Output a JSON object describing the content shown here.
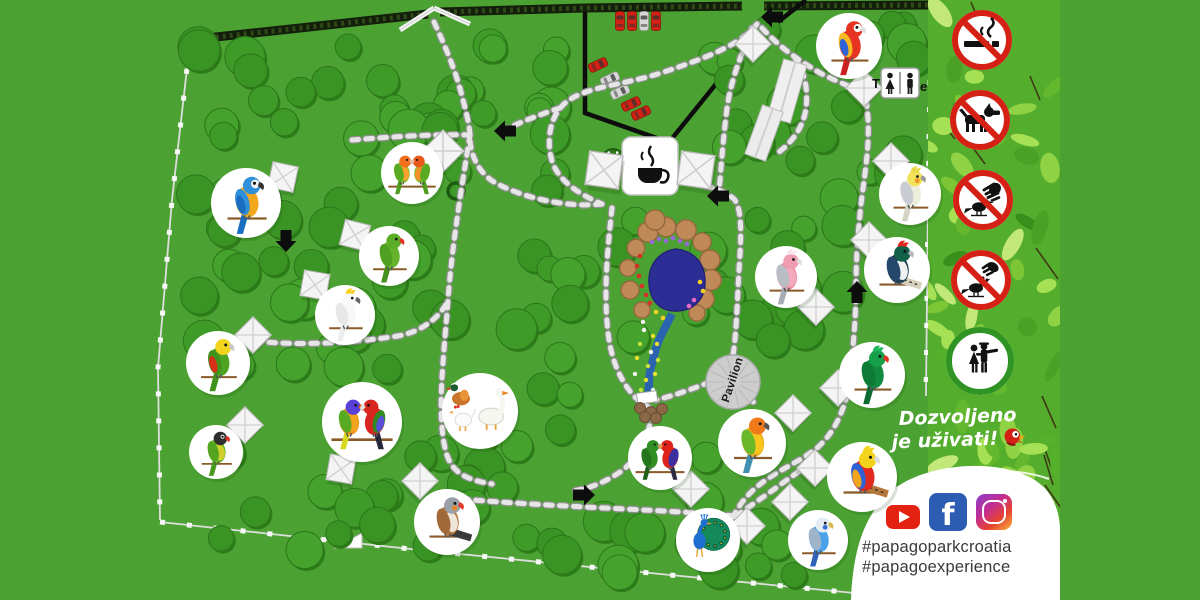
{
  "poster": {
    "slogan": {
      "line1": "Dozvoljeno",
      "line2": "je uživati!"
    },
    "social": {
      "hashtag1": "#papagoparkcroatia",
      "hashtag2": "#papagoexperience",
      "facebook_glyph": "f",
      "icons": [
        "youtube-icon",
        "facebook-icon",
        "instagram-icon"
      ]
    },
    "labels": {
      "pavilion": "Pavilion",
      "toilets_left": "T",
      "toilets_right": "e"
    },
    "signs": [
      {
        "id": "no-smoking",
        "type": "prohibited",
        "glyph": "cigarette"
      },
      {
        "id": "no-dogs",
        "type": "prohibited",
        "glyph": "dog"
      },
      {
        "id": "no-catching-birds",
        "type": "prohibited",
        "glyph": "hand-bird"
      },
      {
        "id": "no-feeding-birds",
        "type": "prohibited",
        "glyph": "feed-bird"
      },
      {
        "id": "visitors-welcome",
        "type": "allowed",
        "glyph": "couple"
      }
    ],
    "amenities": [
      {
        "id": "cafe",
        "icon": "coffee-cup-icon"
      },
      {
        "id": "toilets",
        "icon": "wc-icon"
      },
      {
        "id": "pavilion",
        "icon": "pavilion-circle"
      },
      {
        "id": "parking",
        "icon": "parked-cars"
      }
    ],
    "enclosures": [
      {
        "id": "scarlet-macaw",
        "name": "Scarlet Macaw",
        "x": 849,
        "y": 46,
        "r": 33
      },
      {
        "id": "blue-and-gold-macaw",
        "name": "Blue-and-gold Macaw",
        "x": 246,
        "y": 203,
        "r": 35
      },
      {
        "id": "peach-faced-lovebirds",
        "name": "Peach-faced Lovebirds",
        "x": 412,
        "y": 173,
        "r": 31
      },
      {
        "id": "alexandrine-parakeet",
        "name": "Alexandrine Parakeet",
        "x": 389,
        "y": 256,
        "r": 30
      },
      {
        "id": "white-cockatoo",
        "name": "White Cockatoo",
        "x": 345,
        "y": 315,
        "r": 30
      },
      {
        "id": "yellow-headed-amazon",
        "name": "Yellow-headed Amazon",
        "x": 218,
        "y": 363,
        "r": 32
      },
      {
        "id": "masked-lovebird",
        "name": "Masked Lovebird",
        "x": 216,
        "y": 452,
        "r": 27
      },
      {
        "id": "lorikeet-and-king-parrot",
        "name": "Lorikeet & King Parrot",
        "x": 362,
        "y": 422,
        "r": 40
      },
      {
        "id": "waterfowl-and-poultry",
        "name": "Waterfowl & Poultry",
        "x": 480,
        "y": 411,
        "r": 38
      },
      {
        "id": "zebra-finch",
        "name": "Zebra Finch",
        "x": 447,
        "y": 522,
        "r": 33
      },
      {
        "id": "galah-cockatoo",
        "name": "Galah Cockatoo",
        "x": 786,
        "y": 277,
        "r": 31
      },
      {
        "id": "lady-amherst-pheasant",
        "name": "Lady Amherst's Pheasant",
        "x": 897,
        "y": 270,
        "r": 33
      },
      {
        "id": "cockatiel",
        "name": "Cockatiel",
        "x": 910,
        "y": 194,
        "r": 31
      },
      {
        "id": "green-turaco",
        "name": "Green Turaco",
        "x": 872,
        "y": 375,
        "r": 33
      },
      {
        "id": "king-parrots",
        "name": "King Parrots",
        "x": 660,
        "y": 458,
        "r": 32
      },
      {
        "id": "sun-conure",
        "name": "Sun Conure",
        "x": 752,
        "y": 443,
        "r": 34
      },
      {
        "id": "golden-pheasant",
        "name": "Golden Pheasant",
        "x": 862,
        "y": 477,
        "r": 35
      },
      {
        "id": "peacock",
        "name": "Peacock",
        "x": 708,
        "y": 540,
        "r": 32
      },
      {
        "id": "budgerigar",
        "name": "Budgerigar",
        "x": 818,
        "y": 540,
        "r": 30
      }
    ],
    "colors": {
      "map_green": "#4ba232",
      "tree_green": "#3f9b28",
      "path_stone": "#e3e3e3",
      "pond_blue": "#2d2d96",
      "prohibited_red": "#d42015",
      "allowed_green": "#2f9424",
      "youtube_red": "#e32212",
      "facebook_blue": "#2d5db2"
    }
  }
}
